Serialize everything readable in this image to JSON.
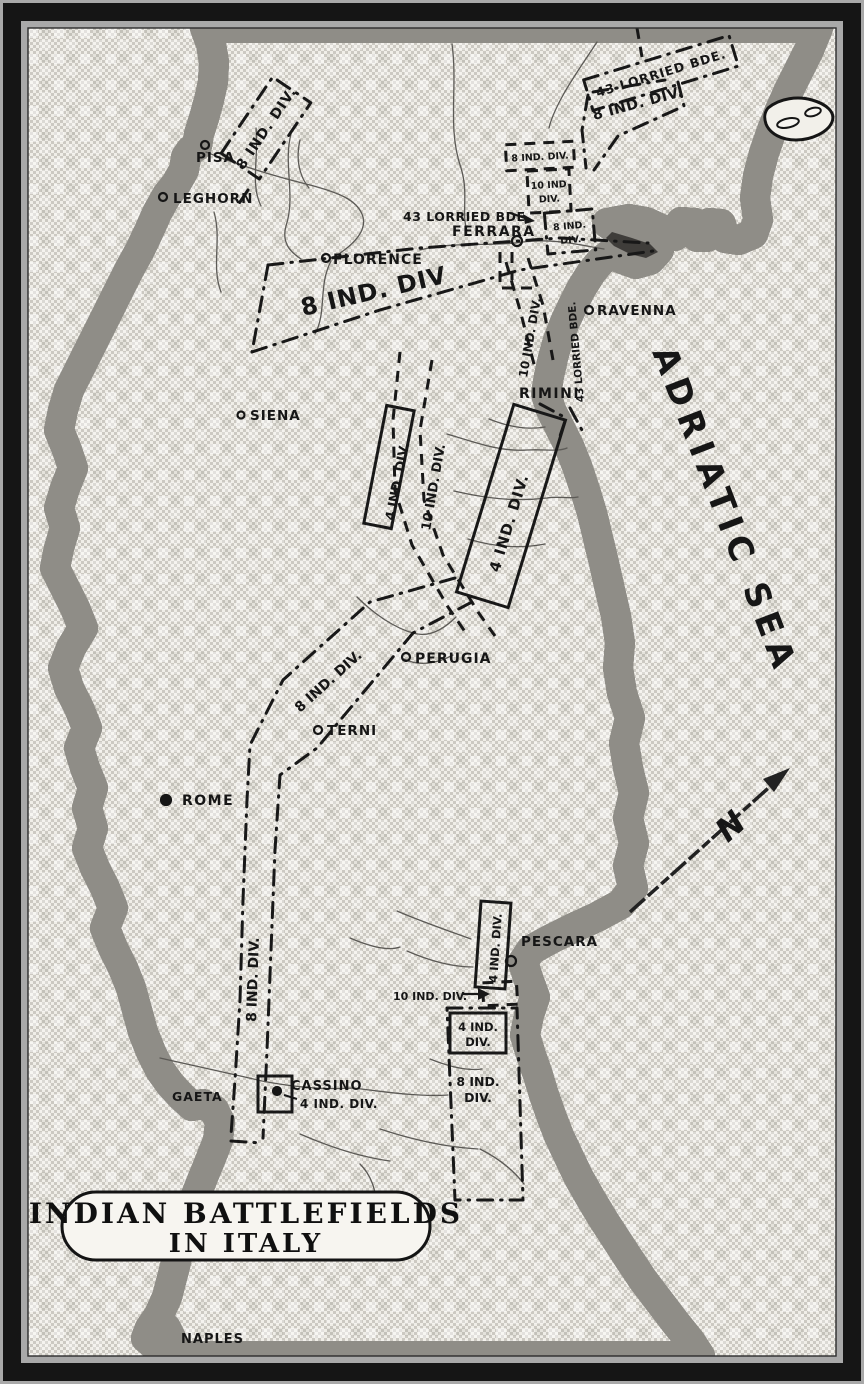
{
  "title_box": {
    "line1": "INDIAN BATTLEFIELDS",
    "line2": "IN ITALY"
  },
  "sea": {
    "name": "ADRIATIC SEA"
  },
  "compass": {
    "north_label": "N"
  },
  "cities": {
    "pisa": "PISA",
    "leghorn": "LEGHORN",
    "florence": "FLORENCE",
    "ferrara": "FERRARA",
    "ravenna": "RAVENNA",
    "rimini": "RIMINI",
    "siena": "SIENA",
    "perugia": "PERUGIA",
    "terni": "TERNI",
    "rome": "ROME",
    "pescara": "PESCARA",
    "gaeta": "GAETA",
    "cassino": "CASSINO",
    "naples": "NAPLES"
  },
  "units": {
    "nw_8_div": "8 IND. DIV.",
    "ne_lorried_bde": "43 LORRIED BDE.",
    "ne_8_div": "8 IND. DIV.",
    "ferrara_lorried_bde": "43 LORRIED BDE.",
    "ferrara_8_div_top": "8 IND. DIV.",
    "ferrara_10_div_line1": "10 IND",
    "ferrara_10_div_line2": "DIV.",
    "ferrara_8_div_line1": "8 IND.",
    "ferrara_8_div_line2": "DIV.",
    "florence_band_8_div": "8 IND. DIV",
    "coast_lorried_bde": "43 LORRIED BDE.",
    "romagna_10_div": "10 IND. DIV.",
    "tuscany_4_div": "4 IND. DIV.",
    "tuscany_10_div": "10 IND. DIV.",
    "adriatic_4_div": "4 IND. DIV.",
    "umbria_8_div": "8 IND. DIV.",
    "lazio_8_div": "8 IND. DIV.",
    "pescara_4_div": "4 IND. DIV.",
    "pescara_10_div": "10 IND. DIV.",
    "sangro_4_div_line1": "4 IND.",
    "sangro_4_div_line2": "DIV.",
    "sangro_8_div_line1": "8 IND.",
    "sangro_8_div_line2": "DIV.",
    "cassino_4_div": "4 IND. DIV."
  },
  "colors": {
    "paper": "#f7f5f0",
    "ink": "#161616",
    "sea_check": "#ccc9c2",
    "frame": "#151515",
    "background": "#a9a9a9"
  }
}
